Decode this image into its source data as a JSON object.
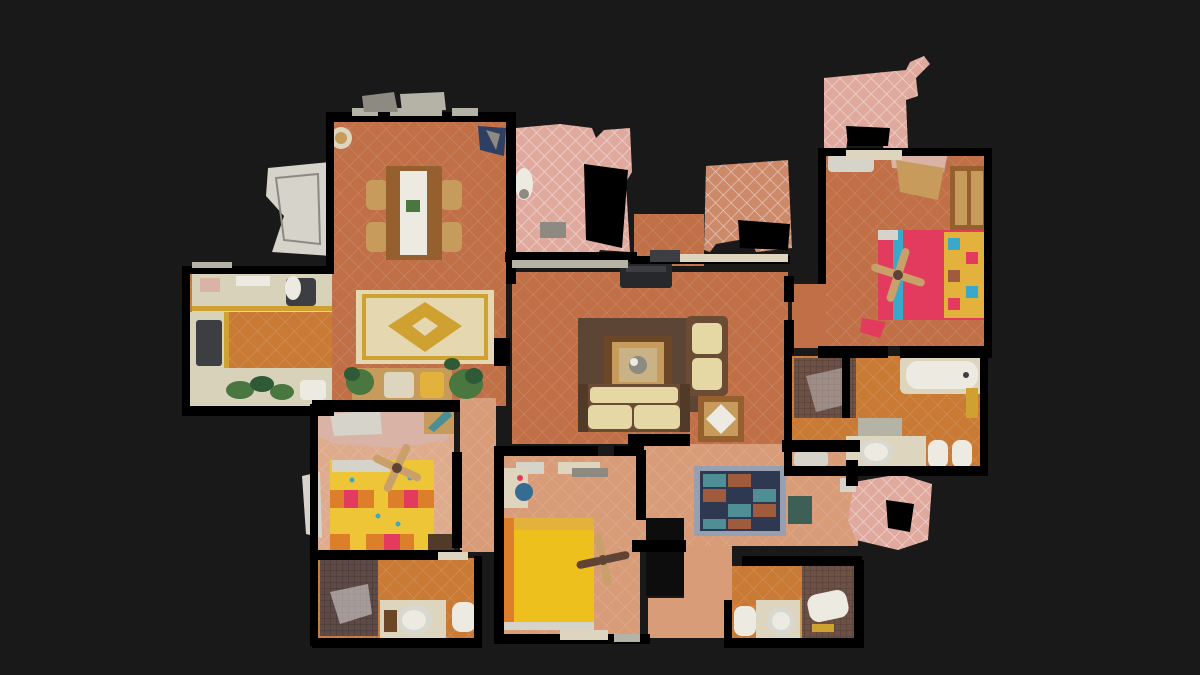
{
  "scene": {
    "type": "3d-dollhouse-floorplan-top-view",
    "description": "Top-down dollhouse view of a scanned apartment with terracotta tile floors, three bedrooms, three bathrooms, kitchen, dining and living areas, and pink-tiled terrace fragments",
    "background_color": "#191919"
  },
  "palette": {
    "bg": "#191919",
    "wall": "#000000",
    "voidDark": "#0d0d0d",
    "terracotta": "#c06f46",
    "orange": "#c97a35",
    "salmon": "#d89c79",
    "salmonLight": "#dfab8d",
    "pinkTile": "#dfa99e",
    "warmTile": "#cd8a6b",
    "wood": "#96602e",
    "woodDark": "#6b4728",
    "woodLight": "#c79b5c",
    "white": "#eceae1",
    "cream": "#ddd5bd",
    "counter": "#d8d2ba",
    "grayDark": "#3c3e42",
    "gray": "#8d8a82",
    "lightSill": "#b5b2a6",
    "navy": "#2d3f63",
    "steelBlue": "#366b92",
    "teal": "#4b8e96",
    "tealDark": "#3d5f55",
    "green": "#49773f",
    "greenDark": "#2e5a36",
    "rugBrown": "#5c4534",
    "rugCream": "#e5d7af",
    "rugGold": "#cfa130",
    "rugNavy": "#2e3850",
    "rugRust": "#a05a3c",
    "rugTeal": "#4f8e95",
    "rugBorder": "#96a0b2",
    "bedRed": "#e23b5d",
    "bedStripe": "#3aa8c8",
    "pillow": "#e2b23c",
    "bedGold": "#eec01e",
    "bedOrange": "#dd7f2a",
    "bedYellow": "#eec537",
    "sofaCream": "#e6d8a4",
    "sofaFrame": "#6a4c34",
    "sofaArm": "#513a28",
    "mosaic": "#6e5146",
    "mosaicDark": "#5e4a46",
    "fanBlade": "#c9a06a",
    "fanDark": "#5f4334",
    "artifactWhite": "#d6d3cb",
    "artifactPink": "#d9b3a6",
    "tvDark": "#26282c",
    "glass": "#c9b386",
    "basinRing": "#d8d8d0"
  },
  "rooms": [
    {
      "name": "dining-room",
      "features": [
        "dining-table",
        "four-chairs",
        "wall-clock",
        "yellow-medallion-rug",
        "window-wall"
      ]
    },
    {
      "name": "kitchen",
      "features": [
        "u-shaped-counter",
        "sink",
        "stove",
        "vegetables-on-counter"
      ]
    },
    {
      "name": "living-room",
      "features": [
        "two-floral-sofas",
        "coffee-table",
        "tv",
        "brown-area-rug",
        "side-table",
        "bench-with-plants"
      ]
    },
    {
      "name": "master-bedroom",
      "features": [
        "red-double-bed",
        "wardrobe",
        "ceiling-fan"
      ]
    },
    {
      "name": "master-bathroom",
      "features": [
        "bathtub",
        "mosaic-shower",
        "sink-counter",
        "toilet",
        "bidet"
      ]
    },
    {
      "name": "bedroom-yellow-check",
      "features": [
        "yellow-orange-checked-bed",
        "ceiling-fan",
        "wardrobe-artifact"
      ]
    },
    {
      "name": "bedroom-gold",
      "features": [
        "gold-bed",
        "ceiling-fan",
        "desk-with-blue-chair"
      ]
    },
    {
      "name": "bathroom-left",
      "features": [
        "dark-mosaic-shower",
        "round-basin-counter",
        "toilet"
      ]
    },
    {
      "name": "bathroom-right",
      "features": [
        "toilet",
        "round-basin-counter",
        "mosaic-bath"
      ]
    },
    {
      "name": "hallway",
      "features": [
        "oriental-tile-rug",
        "teal-door-mat"
      ]
    },
    {
      "name": "terrace-fragments",
      "features": [
        "pink-diamond-tiles",
        "scan-holes",
        "gray-door-mat"
      ]
    }
  ]
}
